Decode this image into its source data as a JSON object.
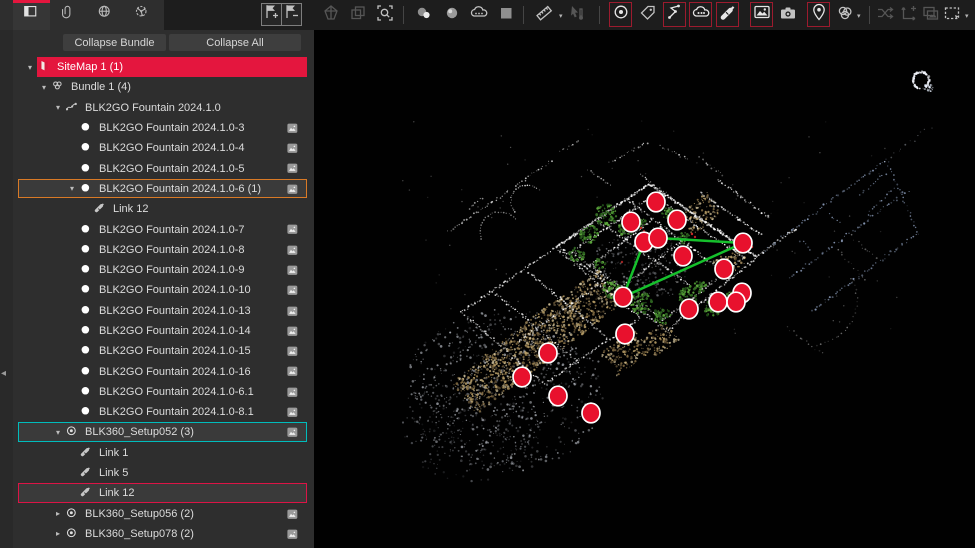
{
  "colors": {
    "accent_red": "#e4163e",
    "select_orange": "#d97a26",
    "select_cyan": "#00bcbc",
    "select_crimson": "#dc1446",
    "marker": "#e8112d",
    "marker_ring": "#ffffff",
    "link": "#16c02c"
  },
  "tabs": [
    {
      "name": "tab-project-explorer",
      "icon": "panel-icon",
      "active": true
    },
    {
      "name": "tab-attachments",
      "icon": "paperclip-icon",
      "active": false
    },
    {
      "name": "tab-world",
      "icon": "globe-icon",
      "active": false
    },
    {
      "name": "tab-network",
      "icon": "network-icon",
      "active": false
    }
  ],
  "panel": {
    "collapse_bundle_label": "Collapse Bundle",
    "collapse_all_label": "Collapse All",
    "tree": [
      {
        "label": "SiteMap 1 (1)",
        "level": 0,
        "icon": "sitemap",
        "arrow": "down",
        "style": "red-fill"
      },
      {
        "label": "Bundle 1 (4)",
        "level": 1,
        "icon": "bundle",
        "arrow": "down"
      },
      {
        "label": "BLK2GO Fountain 2024.1.0",
        "level": 2,
        "icon": "scanpath",
        "arrow": "down"
      },
      {
        "label": "BLK2GO Fountain 2024.1.0-3",
        "level": 3,
        "icon": "dot",
        "img": true
      },
      {
        "label": "BLK2GO Fountain 2024.1.0-4",
        "level": 3,
        "icon": "dot",
        "img": true
      },
      {
        "label": "BLK2GO Fountain 2024.1.0-5",
        "level": 3,
        "icon": "dot",
        "img": true
      },
      {
        "label": "BLK2GO Fountain 2024.1.0-6 (1)",
        "level": 3,
        "icon": "dot",
        "arrow": "down",
        "img": true,
        "style": "border-orange"
      },
      {
        "label": "Link 12",
        "level": 4,
        "icon": "link"
      },
      {
        "label": "BLK2GO Fountain 2024.1.0-7",
        "level": 3,
        "icon": "dot",
        "img": true
      },
      {
        "label": "BLK2GO Fountain 2024.1.0-8",
        "level": 3,
        "icon": "dot",
        "img": true
      },
      {
        "label": "BLK2GO Fountain 2024.1.0-9",
        "level": 3,
        "icon": "dot",
        "img": true
      },
      {
        "label": "BLK2GO Fountain 2024.1.0-10",
        "level": 3,
        "icon": "dot",
        "img": true
      },
      {
        "label": "BLK2GO Fountain 2024.1.0-13",
        "level": 3,
        "icon": "dot",
        "img": true
      },
      {
        "label": "BLK2GO Fountain 2024.1.0-14",
        "level": 3,
        "icon": "dot",
        "img": true
      },
      {
        "label": "BLK2GO Fountain 2024.1.0-15",
        "level": 3,
        "icon": "dot",
        "img": true
      },
      {
        "label": "BLK2GO Fountain 2024.1.0-16",
        "level": 3,
        "icon": "dot",
        "img": true
      },
      {
        "label": "BLK2GO Fountain 2024.1.0-6.1",
        "level": 3,
        "icon": "dot",
        "img": true
      },
      {
        "label": "BLK2GO Fountain 2024.1.0-8.1",
        "level": 3,
        "icon": "dot",
        "img": true
      },
      {
        "label": "BLK360_Setup052 (3)",
        "level": 2,
        "icon": "target",
        "arrow": "down",
        "img": true,
        "style": "border-cyan"
      },
      {
        "label": "Link 1",
        "level": 3,
        "icon": "link"
      },
      {
        "label": "Link 5",
        "level": 3,
        "icon": "link"
      },
      {
        "label": "Link 12",
        "level": 3,
        "icon": "link",
        "style": "border-crimson"
      },
      {
        "label": "BLK360_Setup056 (2)",
        "level": 2,
        "icon": "target",
        "arrow": "right",
        "img": true
      },
      {
        "label": "BLK360_Setup078 (2)",
        "level": 2,
        "icon": "target",
        "arrow": "right",
        "img": true
      }
    ]
  },
  "toolbar": [
    {
      "name": "add-sitemap-button",
      "icon": "flag-plus-icon",
      "flag": true
    },
    {
      "name": "remove-sitemap-button",
      "icon": "flag-minus-icon",
      "flag": true
    },
    {
      "name": "bundle-tool-button",
      "icon": "prism-icon",
      "disabled": true
    },
    {
      "name": "copy-view-button",
      "icon": "copy-icon",
      "disabled": true
    },
    {
      "name": "zoom-region-button",
      "icon": "zoom-region-icon"
    },
    {
      "name": "sep"
    },
    {
      "name": "point-size-button",
      "icon": "spheres-icon"
    },
    {
      "name": "sphere-view-button",
      "icon": "sphere-icon"
    },
    {
      "name": "cloud-display-button",
      "icon": "cloud-stack-icon"
    },
    {
      "name": "flat-shade-button",
      "icon": "square-icon"
    },
    {
      "name": "sep"
    },
    {
      "name": "measure-button",
      "icon": "ruler-icon",
      "caret": true
    },
    {
      "name": "pick-point-button",
      "icon": "cursor-temp-icon",
      "disabled": true
    },
    {
      "name": "sep"
    },
    {
      "name": "show-setups-button",
      "icon": "circle-dot-icon",
      "boxed": true
    },
    {
      "name": "tag-button",
      "icon": "tag-icon"
    },
    {
      "name": "show-links-button",
      "icon": "path-nodes-icon",
      "boxed": true
    },
    {
      "name": "show-bundle-clouds-button",
      "icon": "cloud-bundle-icon",
      "boxed": true
    },
    {
      "name": "create-link-button",
      "icon": "link-pencil-icon",
      "boxed": true
    },
    {
      "name": "show-images-button",
      "icon": "image-icon",
      "boxed": true
    },
    {
      "name": "screenshot-button",
      "icon": "camera-icon"
    },
    {
      "name": "geotag-button",
      "icon": "location-pin-icon",
      "boxed": true
    },
    {
      "name": "auto-cloud-button",
      "icon": "knot-icon",
      "caret": true
    },
    {
      "name": "sep"
    },
    {
      "name": "swap-setups-button",
      "icon": "shuffle-icon",
      "disabled": true
    },
    {
      "name": "move-axes-button",
      "icon": "axes-plus-icon",
      "disabled": true
    },
    {
      "name": "image-stack-button",
      "icon": "images-stack-icon",
      "disabled": true
    },
    {
      "name": "select-region-button",
      "icon": "dashed-rect-icon",
      "caret": true
    }
  ],
  "viewport": {
    "markers": [
      [
        656,
        202
      ],
      [
        631,
        222
      ],
      [
        677,
        220
      ],
      [
        644,
        242
      ],
      [
        658,
        238
      ],
      [
        683,
        256
      ],
      [
        743,
        243
      ],
      [
        724,
        269
      ],
      [
        623,
        297
      ],
      [
        689,
        309
      ],
      [
        718,
        302
      ],
      [
        742,
        293
      ],
      [
        736,
        302
      ],
      [
        625,
        334
      ],
      [
        548,
        353
      ],
      [
        522,
        377
      ],
      [
        558,
        396
      ],
      [
        591,
        413
      ]
    ],
    "links": [
      [
        658,
        238,
        743,
        243
      ],
      [
        743,
        243,
        623,
        297
      ],
      [
        644,
        242,
        623,
        297
      ]
    ]
  }
}
